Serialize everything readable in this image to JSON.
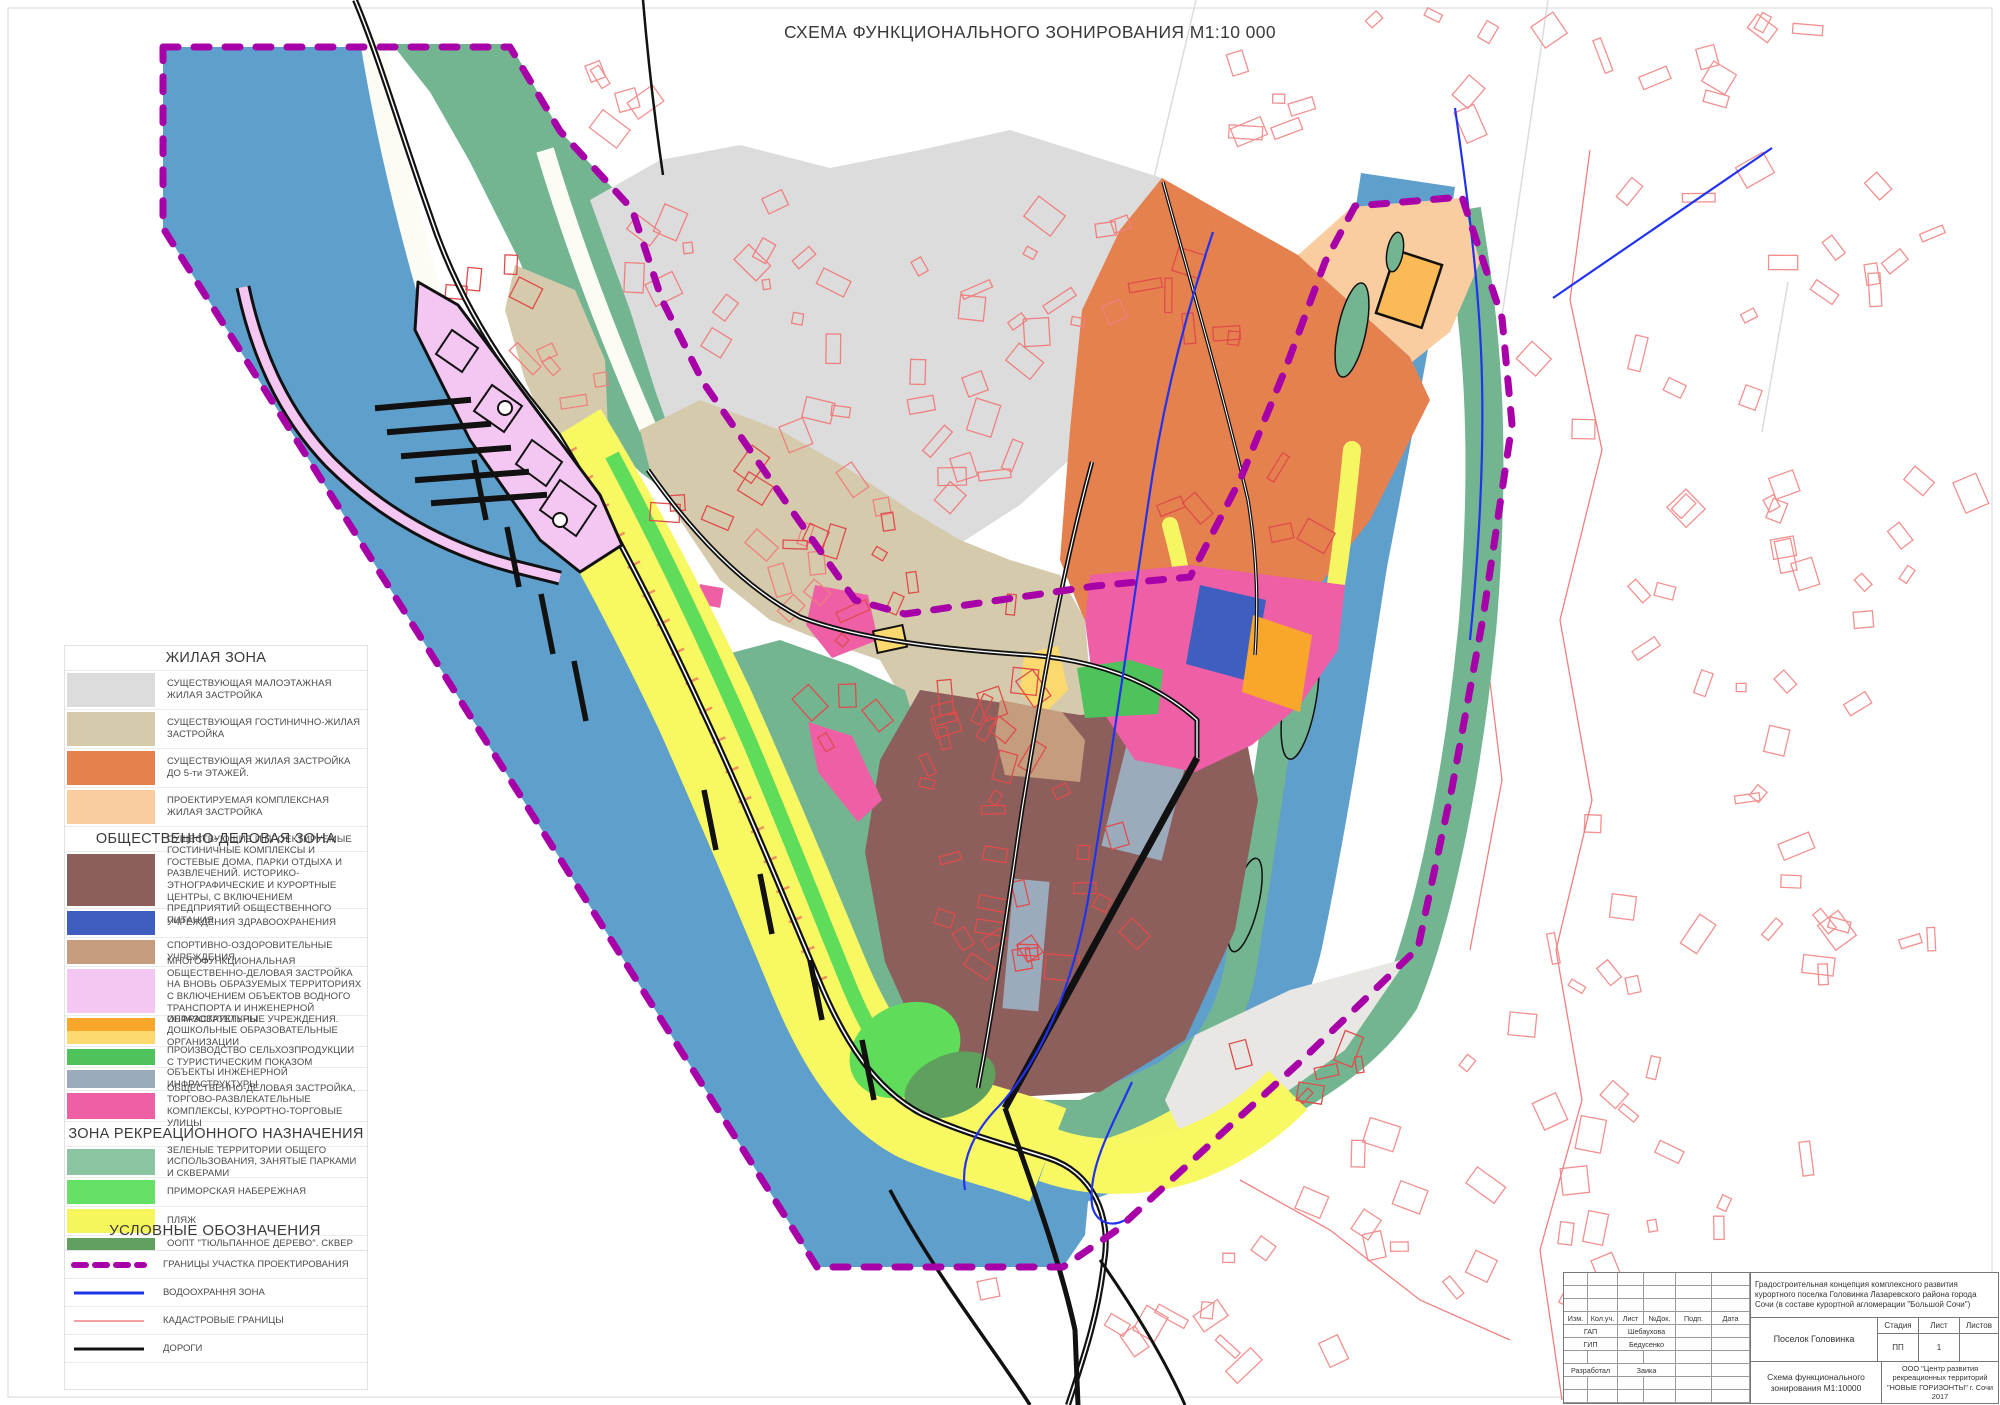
{
  "title": "СХЕМА ФУНКЦИОНАЛЬНОГО ЗОНИРОВАНИЯ М1:10 000",
  "legend": {
    "residential_header": "ЖИЛАЯ ЗОНА",
    "residential": [
      {
        "color": "#DCDCDC",
        "label": "СУЩЕСТВУЮЩАЯ МАЛОЭТАЖНАЯ ЖИЛАЯ ЗАСТРОЙКА"
      },
      {
        "color": "#D6CAAD",
        "label": "СУЩЕСТВУЮЩАЯ ГОСТИНИЧНО-ЖИЛАЯ ЗАСТРОЙКА"
      },
      {
        "color": "#E5814E",
        "label": "СУЩЕСТВУЮЩАЯ ЖИЛАЯ ЗАСТРОЙКА ДО 5-ти ЭТАЖЕЙ."
      },
      {
        "color": "#FACDA0",
        "label": "ПРОЕКТИРУЕМАЯ КОМПЛЕКСНАЯ ЖИЛАЯ ЗАСТРОЙКА"
      }
    ],
    "business_header": "ОБЩЕСТВЕННО-ДЕЛОВАЯ ЗОНА",
    "business": [
      {
        "color": "#8D5F5C",
        "label": "СУЩЕСТВУЮЩИЕ И ПРОЕКТИРУЕМЫЕ ГОСТИНИЧНЫЕ КОМПЛЕКСЫ И ГОСТЕВЫЕ ДОМА, ПАРКИ ОТДЫХА И РАЗВЛЕЧЕНИЙ. ИСТОРИКО-ЭТНОГРАФИЧЕСКИЕ И КУРОРТНЫЕ ЦЕНТРЫ, С ВКЛЮЧЕНИЕМ ПРЕДПРИЯТИЙ ОБЩЕСТВЕННОГО ПИТАНИЯ."
      },
      {
        "color": "#3E5EC0",
        "label": "УЧРЕЖДЕНИЯ ЗДРАВООХРАНЕНИЯ"
      },
      {
        "color": "#C59C7D",
        "label": "СПОРТИВНО-ОЗДОРОВИТЕЛЬНЫЕ УЧРЕЖДЕНИЯ"
      },
      {
        "color": "#F4C7F2",
        "label": "МНОГОФУНКЦИОНАЛЬНАЯ ОБЩЕСТВЕННО-ДЕЛОВАЯ ЗАСТРОЙКА НА ВНОВЬ ОБРАЗУЕМЫХ ТЕРРИТОРИЯХ С ВКЛЮЧЕНИЕМ ОБЪЕКТОВ ВОДНОГО ТРАНСПОРТА И ИНЖЕНЕРНОЙ ИНФРАСТРУКТУРЫ"
      },
      {
        "color": "#F9A72B",
        "color2": "#FBD96E",
        "label": "ОБРАЗОВАТЕЛЬНЫЕ УЧРЕЖДЕНИЯ. ДОШКОЛЬНЫЕ ОБРАЗОВАТЕЛЬНЫЕ ОРГАНИЗАЦИИ"
      },
      {
        "color": "#4EC35C",
        "label": "ПРОИЗВОДСТВО СЕЛЬХОЗПРОДУКЦИИ С ТУРИСТИЧЕСКИМ ПОКАЗОМ"
      },
      {
        "color": "#9CABBC",
        "label": "ОБЪЕКТЫ ИНЖЕНЕРНОЙ ИНФРАСТРУКТУРЫ"
      },
      {
        "color": "#EE5FA5",
        "label": "ОБЩЕСТВЕННО-ДЕЛОВАЯ ЗАСТРОЙКА, ТОРГОВО-РАЗВЛЕКАТЕЛЬНЫЕ КОМПЛЕКСЫ, КУРОРТНО-ТОРГОВЫЕ УЛИЦЫ"
      }
    ],
    "recreation_header": "ЗОНА РЕКРЕАЦИОННОГО НАЗНАЧЕНИЯ",
    "recreation": [
      {
        "color": "#8BC4A0",
        "label": "ЗЕЛЕНЫЕ ТЕРРИТОРИИ ОБЩЕГО ИСПОЛЬЗОВАНИЯ, ЗАНЯТЫЕ ПАРКАМИ И СКВЕРАМИ"
      },
      {
        "color": "#66E066",
        "label": "ПРИМОРСКАЯ НАБЕРЕЖНАЯ"
      },
      {
        "color": "#F5F55C",
        "label": "ПЛЯЖ"
      },
      {
        "color": "#62A062",
        "label": "ООПТ \"ТЮЛЬПАННОЕ ДЕРЕВО\". СКВЕР \"ЛИРАН\""
      }
    ],
    "symbols_header": "УСЛОВНЫЕ ОБОЗНАЧЕНИЯ",
    "symbols": [
      {
        "color": "#A800A8",
        "label": "ГРАНИЦЫ УЧАСТКА ПРОЕКТИРОВАНИЯ"
      },
      {
        "color": "#2233EE",
        "label": "ВОДООХРАННЯ ЗОНА"
      },
      {
        "color": "#F4A0A0",
        "label": "КАДАСТРОВЫЕ ГРАНИЦЫ"
      },
      {
        "color": "#111111",
        "label": "ДОРОГИ"
      }
    ]
  },
  "stamp": {
    "cols": [
      "Изм.",
      "Кол.уч.",
      "Лист",
      "№Док.",
      "Подп.",
      "Дата"
    ],
    "rows": [
      {
        "role": "ГАП",
        "name": "Шебаухова"
      },
      {
        "role": "ГИП",
        "name": "Бедусенко"
      },
      {
        "role": "Разработал",
        "name": "Заика"
      }
    ],
    "description": "Градостроительная концепция комплексного развития курортного поселка Головинка Лазаревского района города Сочи (в составе курортной агломерации \"Большой Сочи\")",
    "object": "Поселок Головинка",
    "stage_label": "Стадия",
    "sheet_label": "Лист",
    "sheets_label": "Листов",
    "stage": "ПП",
    "sheet": "1",
    "sheets": "",
    "drawing": "Схема функционального зонирования М1:10000",
    "org": "ООО \"Центр развития рекреационных территорий \"НОВЫЕ ГОРИЗОНТЫ\" г. Сочи 2017"
  }
}
